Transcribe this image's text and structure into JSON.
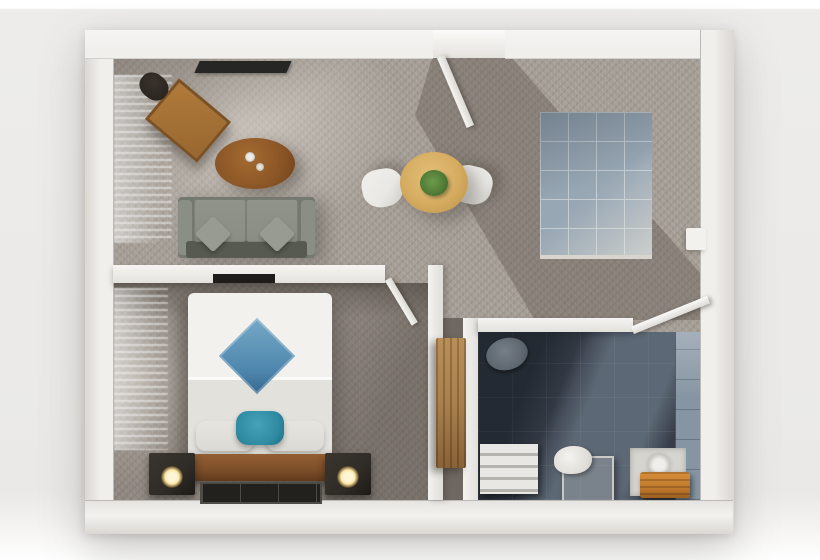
{
  "scene": {
    "view": "top-down 3D render",
    "subject": "one-bedroom apartment floor plan",
    "rooms": [
      {
        "id": "living-room",
        "position": "top-left",
        "floor": "gray carpet",
        "furniture": [
          "wall-mounted-tv",
          "corner-desk",
          "desk-chair",
          "round-coffee-table",
          "coffee-cups",
          "two-seat-sofa",
          "throw-pillows"
        ]
      },
      {
        "id": "dining-area",
        "position": "center",
        "floor": "gray carpet",
        "furniture": [
          "round-dining-table",
          "potted-plant-centerpiece",
          "dining-chair-left",
          "dining-chair-right"
        ]
      },
      {
        "id": "kitchen",
        "position": "top-right",
        "floor": "blue-gray tile",
        "furniture": [
          "l-shaped-oak-counter",
          "sink",
          "two-burner-cooktop",
          "counter-end-cabinet",
          "wall-radiator"
        ]
      },
      {
        "id": "bedroom",
        "position": "bottom-left",
        "floor": "gray carpet",
        "furniture": [
          "double-bed",
          "blue-diamond-blanket",
          "teal-accent-pillow",
          "white-pillows",
          "wood-headboard",
          "nightstand-left",
          "nightstand-right",
          "glowing-lamp-left",
          "glowing-lamp-right",
          "dark-floor-mat",
          "wall-mounted-tv"
        ]
      },
      {
        "id": "bathroom",
        "position": "bottom-right",
        "floor": "dark slate tile",
        "furniture": [
          "toilet",
          "towel-shelf-unit",
          "stool-with-towel",
          "shower-mat",
          "wooden-bench"
        ]
      },
      {
        "id": "hallway-nook",
        "position": "center-right",
        "floor": "gray carpet",
        "furniture": [
          "tall-wood-cabinet"
        ]
      }
    ],
    "doors": [
      {
        "id": "entry-door",
        "wall": "top",
        "state": "open"
      },
      {
        "id": "bedroom-door",
        "wall": "living-bedroom-divider",
        "state": "open"
      },
      {
        "id": "bathroom-door",
        "wall": "bathroom-top",
        "state": "open"
      }
    ],
    "windows": [
      {
        "id": "living-room-window",
        "wall": "left",
        "treatment": "blinds with light streaks"
      },
      {
        "id": "bedroom-window",
        "wall": "left",
        "treatment": "blinds with light streaks"
      }
    ]
  },
  "colors": {
    "wall": "#f0efec",
    "wall_shade": "#dbd8d3",
    "carpet": "#a49d95",
    "carpet_shadow": "#6f6862",
    "oak": "#c99a4d",
    "oak_dark": "#a87a30",
    "counter_white": "#edebe6",
    "stove_black": "#1f1e1c",
    "kitchen_tile": "#98a7b4",
    "kitchen_tile_line": "#c3ccd2",
    "desk_wood": "#98672f",
    "chair_dark": "#26211c",
    "coffee_table": "#8a5526",
    "coffee_table_dark": "#6e4018",
    "dining_wood": "#d5ab60",
    "plant_green": "#4f7a36",
    "chair_white": "#e9e8e4",
    "sofa": "#75786f",
    "sofa_light": "#8b8e85",
    "sofa_dark": "#565a51",
    "tv_black": "#262624",
    "bed_white": "#f2f1ed",
    "bed_shade": "#e2e1dc",
    "diamond_blue": "#4d86ad",
    "diamond_blue_light": "#77a9c6",
    "teal": "#2e8aa1",
    "pillow_white": "#dbd9d3",
    "headboard_wood": "#7c4e29",
    "nightstand": "#2f2b26",
    "lamp_glow": "#ffe9a8",
    "mat_dark": "#22211e",
    "mat_line": "#4d4b45",
    "bath_floor": "#363d48",
    "bath_wall_tile": "#8695a3",
    "toilet_gray": "#5f6771",
    "shelf_white": "#e8e7e3",
    "tray_light": "#d5d4cf",
    "bench_wood": "#c07a2e",
    "cabinet_wood": "#a97f4c",
    "cabinet_wood_dark": "#8a6237",
    "door_white": "#f6f5f2"
  }
}
